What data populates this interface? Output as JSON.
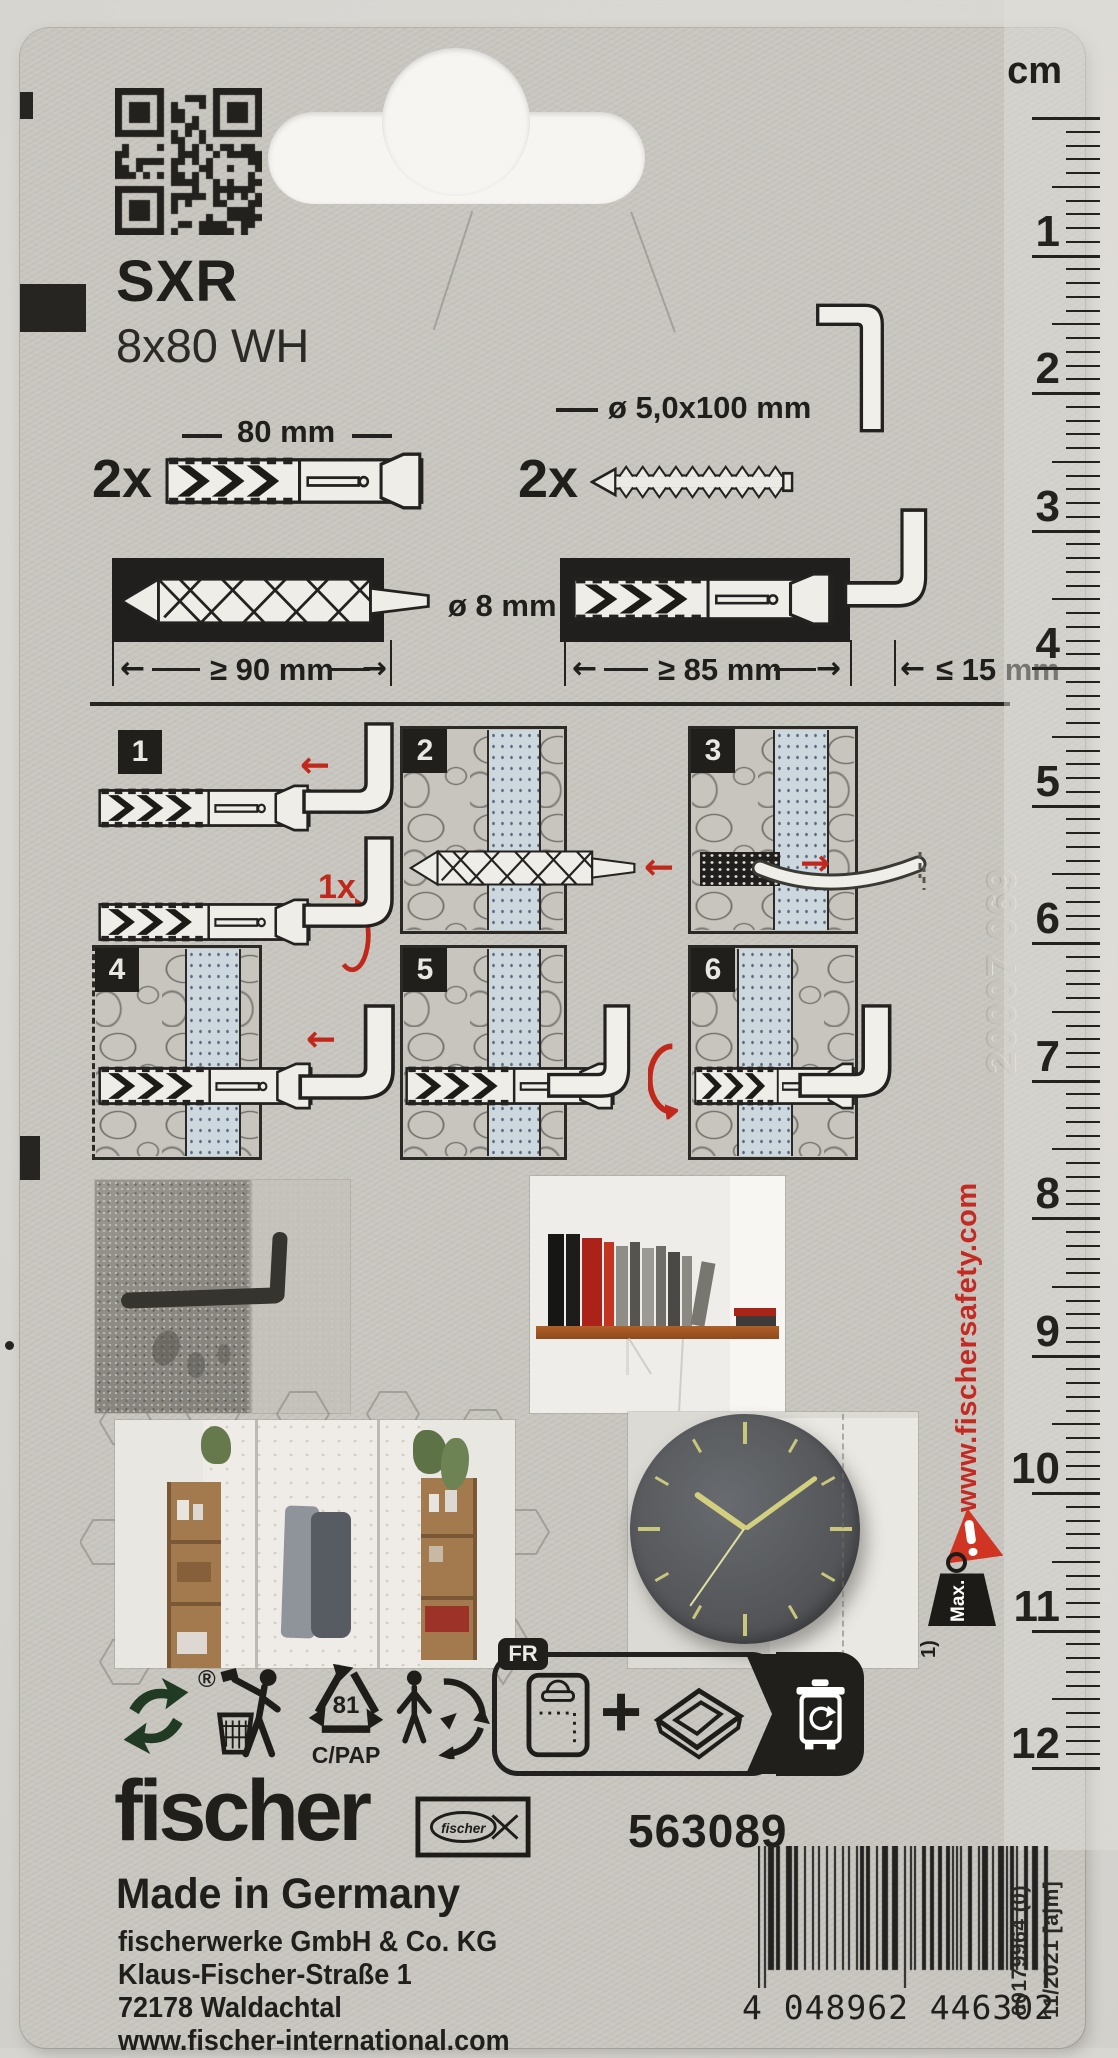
{
  "product": {
    "series": "SXR",
    "size": "8x80 WH",
    "article_no": "563089",
    "made_in": "Made in Germany"
  },
  "components": {
    "plug_qty": "2x",
    "plug_length": "80 mm",
    "screw_qty": "2x",
    "screw_dim": "ø 5,0x100 mm"
  },
  "drilling": {
    "drill_diameter": "ø 8 mm",
    "hole_depth": "≥ 90 mm",
    "anchor_depth": "≥ 85 mm",
    "hook_protrusion": "≤ 15 mm"
  },
  "steps": {
    "numbers": [
      "1",
      "2",
      "3",
      "4",
      "5",
      "6"
    ],
    "turn_count": "1x"
  },
  "sidebar": {
    "website": "www.fischersafety.com",
    "max_label": "Max.",
    "footnote": "1)",
    "embossed_code": "20007 069"
  },
  "ruler": {
    "unit": "cm",
    "numbers": [
      "1",
      "2",
      "3",
      "4",
      "5",
      "6",
      "7",
      "8",
      "9",
      "10",
      "11",
      "12"
    ]
  },
  "recycling": {
    "resin_code": "81",
    "material": "C/PAP",
    "country": "FR",
    "green_dot_reg": "®"
  },
  "footer": {
    "brand": "fischer",
    "company": "fischerwerke GmbH & Co. KG",
    "street": "Klaus-Fischer-Straße 1",
    "city": "72178 Waldachtal",
    "website": "www.fischer-international.com"
  },
  "barcode": {
    "number": "4 048962 446302",
    "print_ref": "00179964 (0)",
    "date_code": "11/2021 [ajm]"
  },
  "colors": {
    "accent_red": "#c0281c",
    "card": "#c8c6bf",
    "ink": "#201f1c"
  }
}
